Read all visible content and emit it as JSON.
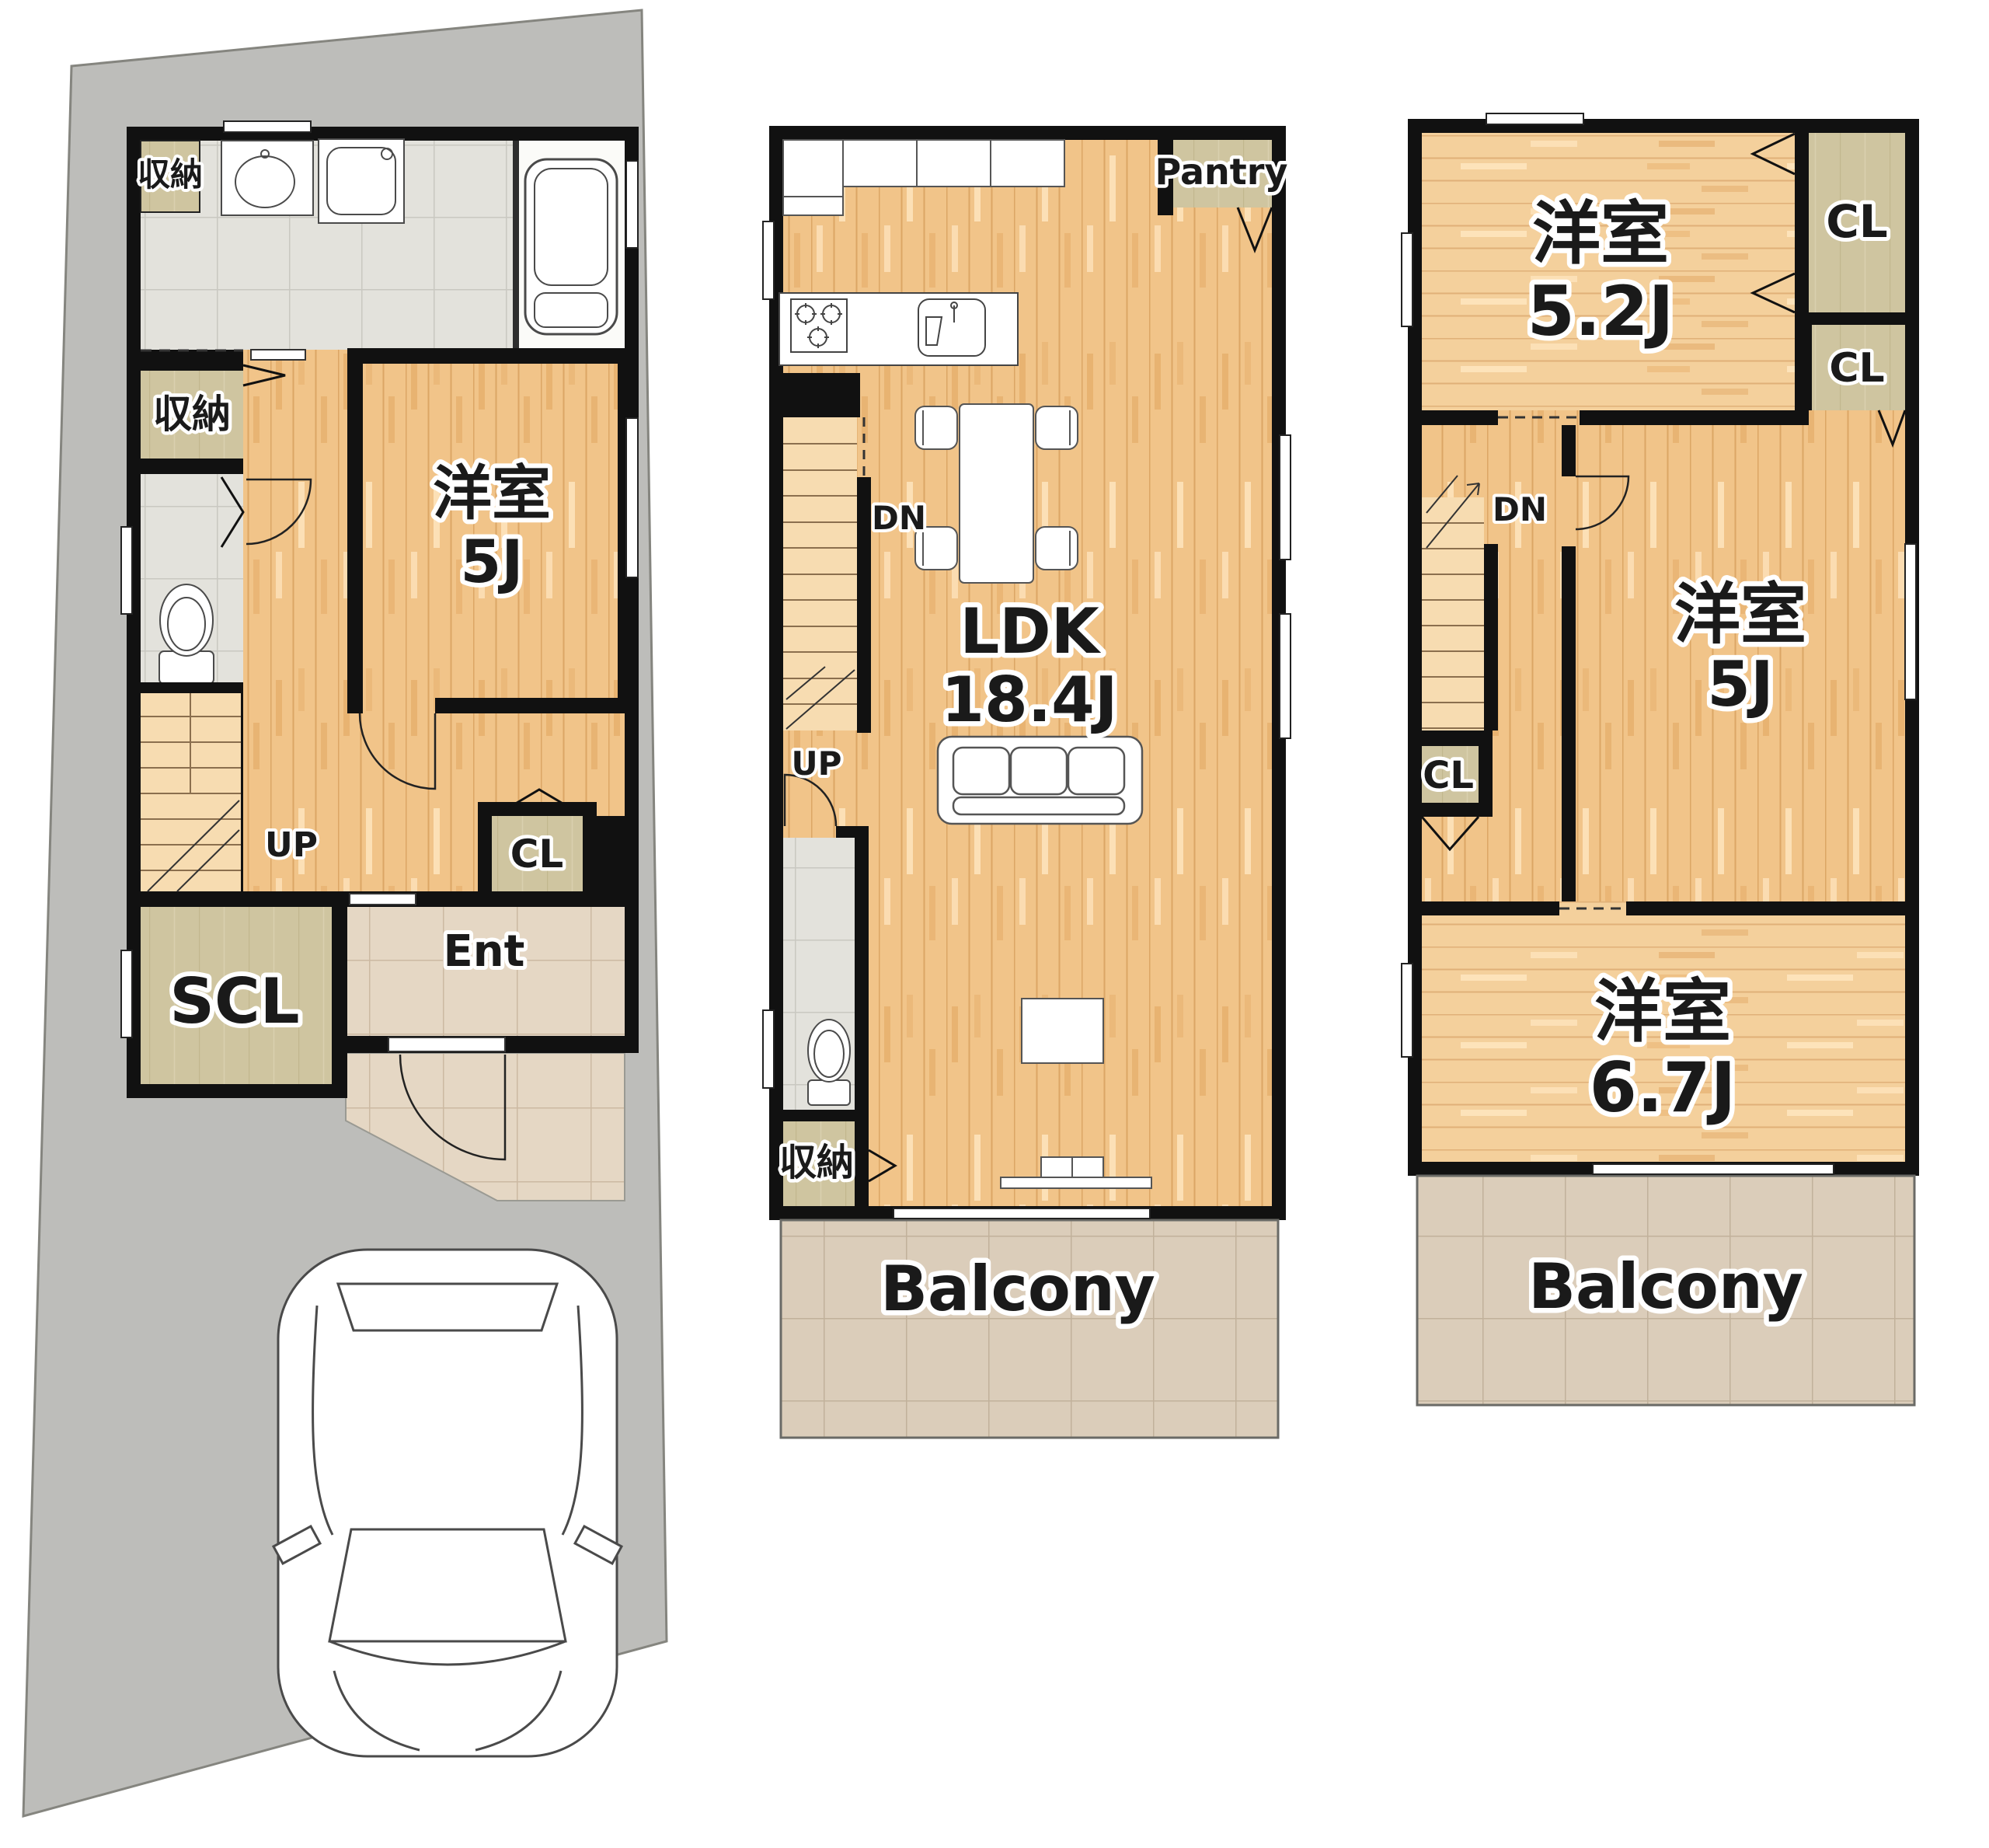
{
  "title": "3-story house floor plan",
  "colors": {
    "wall": "#111111",
    "wood": "#f1c489",
    "wood_light": "#f4d09c",
    "stair_wood": "#f7dcb1",
    "closet_tan": "#cfc5a0",
    "wash_tile": "#e3e2dc",
    "entrance_tile": "#e5d7c4",
    "balcony_tile": "#dbcdba",
    "site_concrete": "#bdbdba"
  },
  "floor1": {
    "storage1": "収納",
    "storage2": "収納",
    "room": "洋室",
    "room_size": "5J",
    "up": "UP",
    "cl": "CL",
    "scl": "SCL",
    "ent": "Ent"
  },
  "floor2": {
    "pantry": "Pantry",
    "dn": "DN",
    "ldk": "LDK",
    "ldk_size": "18.4J",
    "up": "UP",
    "storage": "収納",
    "balcony": "Balcony"
  },
  "floor3": {
    "room1": "洋室",
    "room1_size": "5.2J",
    "cl1": "CL",
    "cl2": "CL",
    "dn": "DN",
    "room2": "洋室",
    "room2_size": "5J",
    "cl3": "CL",
    "room3": "洋室",
    "room3_size": "6.7J",
    "balcony": "Balcony"
  }
}
